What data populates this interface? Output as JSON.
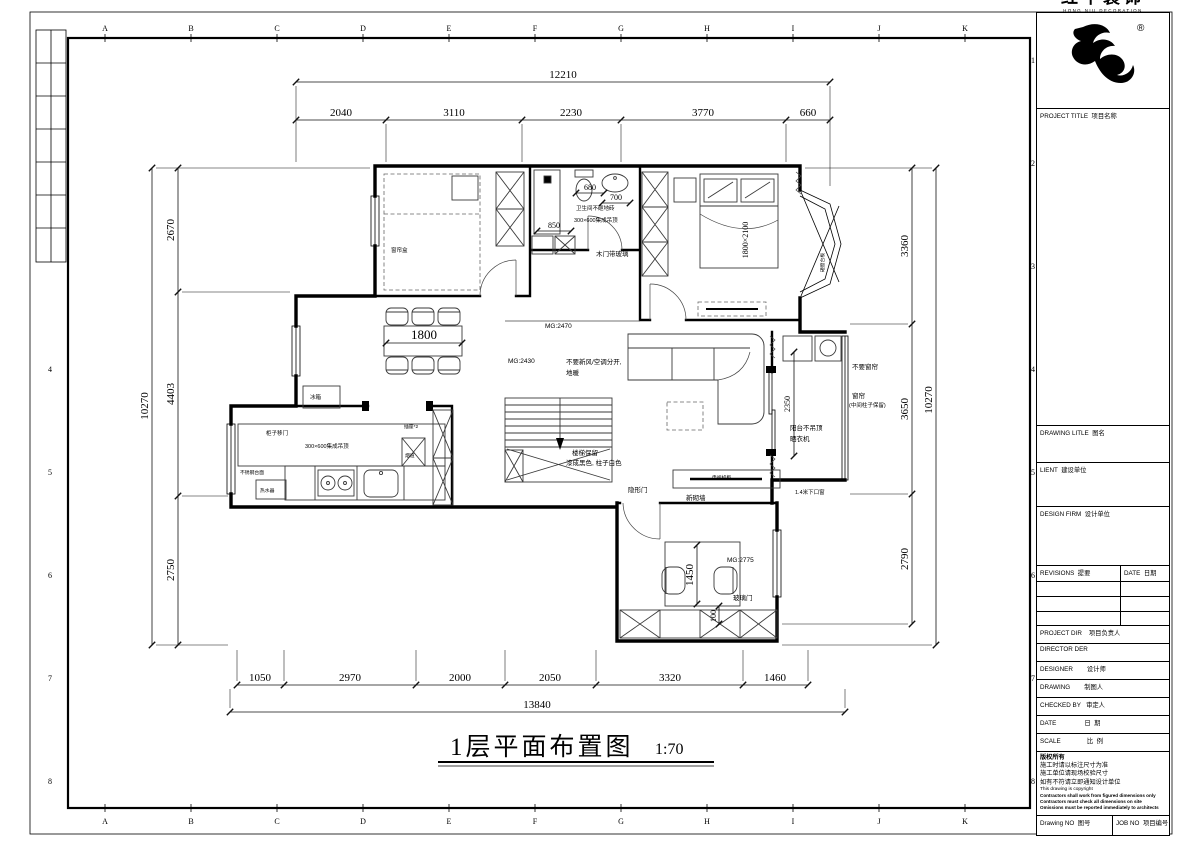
{
  "frame": {
    "grid_letters": [
      "A",
      "B",
      "C",
      "D",
      "E",
      "F",
      "G",
      "H",
      "I",
      "J",
      "K"
    ],
    "grid_numbers": [
      "1",
      "2",
      "3",
      "4",
      "5",
      "6",
      "7",
      "8"
    ]
  },
  "title_block": {
    "registered": "®",
    "brand_cn": "红牛装饰",
    "brand_en": "HONG NIU DECORATION",
    "project_title": "PROJECT TITLE  项目名称",
    "drawing_title": "DRAWING LITLE  图名",
    "client": "LIENT  建设单位",
    "design_firm": "DESIGN FIRM  设计单位",
    "revisions": "REVISIONS  提要",
    "date_col": "DATE  日期",
    "project_dir": "PROJECT DIR    项目负责人",
    "director": "DIRECTOR DER",
    "designer": "DESIGNER        设计师",
    "drawn_by": "DRAWING        制图人",
    "checked_by": "CHECKED BY   审定人",
    "date": "DATE                日  期",
    "scale": "SCALE               比  例",
    "copyright_title": "版权所有",
    "copyright_cn1": "施工时请以标注尺寸为准",
    "copyright_cn2": "施工单位请现场校验尺寸",
    "copyright_cn3": "如有不符请立即通知设计单位",
    "copyright_en": "This drawing is copyright",
    "copyright_en1": "Contractors shall work from figured dimensions only",
    "copyright_en2": "Contractors must check all dimensions on site",
    "copyright_en3": "Omissions must be reported immediately to architects",
    "drawing_no": "Drawing NO  图号",
    "job_no": "JOB NO  项目编号"
  },
  "plan": {
    "title": "1层平面布置图",
    "scale": "1:70",
    "dims": {
      "top_total": "12210",
      "top": [
        "2040",
        "3110",
        "2230",
        "3770",
        "660"
      ],
      "left_total": "10270",
      "left": [
        "2670",
        "4403",
        "2750"
      ],
      "right_total": "10270",
      "right": [
        "3360",
        "3650",
        "2790"
      ],
      "bottom_total": "13840",
      "bottom": [
        "1050",
        "2970",
        "2000",
        "2050",
        "3320",
        "1460"
      ],
      "bath_width": "680",
      "basin": "700",
      "shower": "850",
      "dining_table": "1800",
      "balcony": "2350",
      "desk": "1450",
      "desk_gap": "100",
      "bed": "1800×2100",
      "mg_hall": "MG:2470",
      "mg_dining": "MG:2430",
      "mg_study": "MG:2775"
    },
    "notes": {
      "curtain_box": "窗帘盒",
      "bath_floor": "卫生间不砸地砖",
      "bath_ceiling": "300×600集成吊顶",
      "bath_door": "木门带玻璃",
      "hvac1": "不要新风/空调分开,",
      "hvac2": "地暖",
      "stair1": "楼梯保留",
      "stair2": "漆成黑色, 柱子白色",
      "hidden_door": "隐形门",
      "new_wall": "新砌墙",
      "glass_door": "玻璃门",
      "low_window": "1.4米下口窗",
      "no_curtain": "不要窗帘",
      "curtain1": "窗帘",
      "curtain2": "(中间柱子保留)",
      "balcony1": "阳台不吊顶",
      "balcony2": "晒衣机",
      "fridge": "冰箱",
      "water_heater": "热水器",
      "kitchen_ceiling": "300×600集成吊顶",
      "cabinet_slider": "柜子移门",
      "counter": "不锈钢台面",
      "flue": "烟道",
      "socket": "插座*2",
      "tv_cabinet": "电视机柜",
      "bay_note": "砸窗台板"
    }
  }
}
